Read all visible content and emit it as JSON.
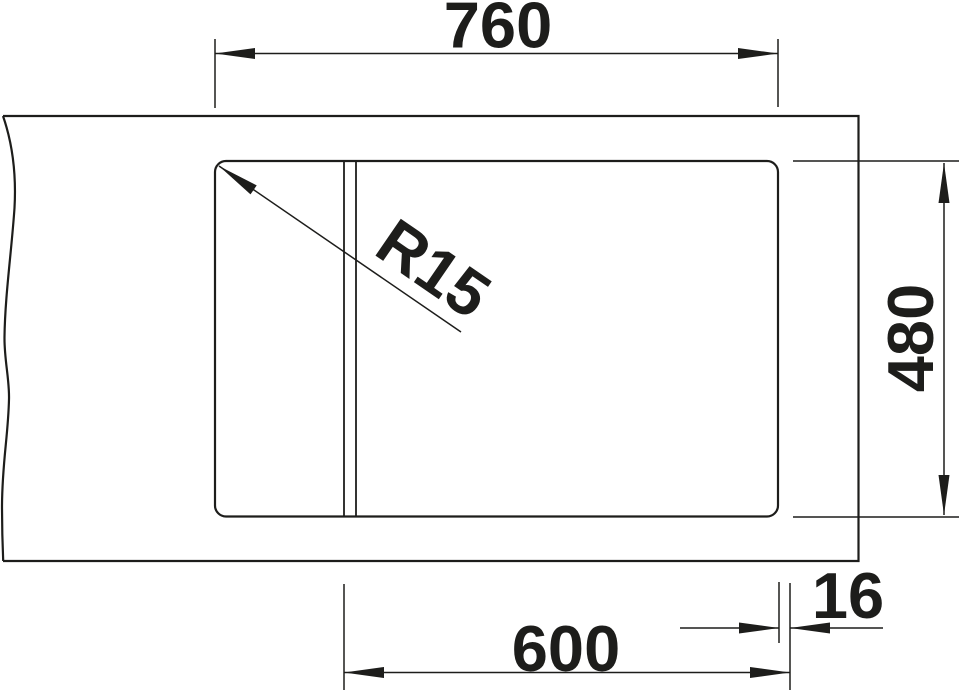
{
  "drawing": {
    "ink_color": "#1d1d1b",
    "background_color": "#ffffff",
    "labels": {
      "overall_width": "760",
      "overall_depth": "480",
      "cabinet_width": "600",
      "edge_offset": "16",
      "corner_radius": "R15"
    }
  }
}
